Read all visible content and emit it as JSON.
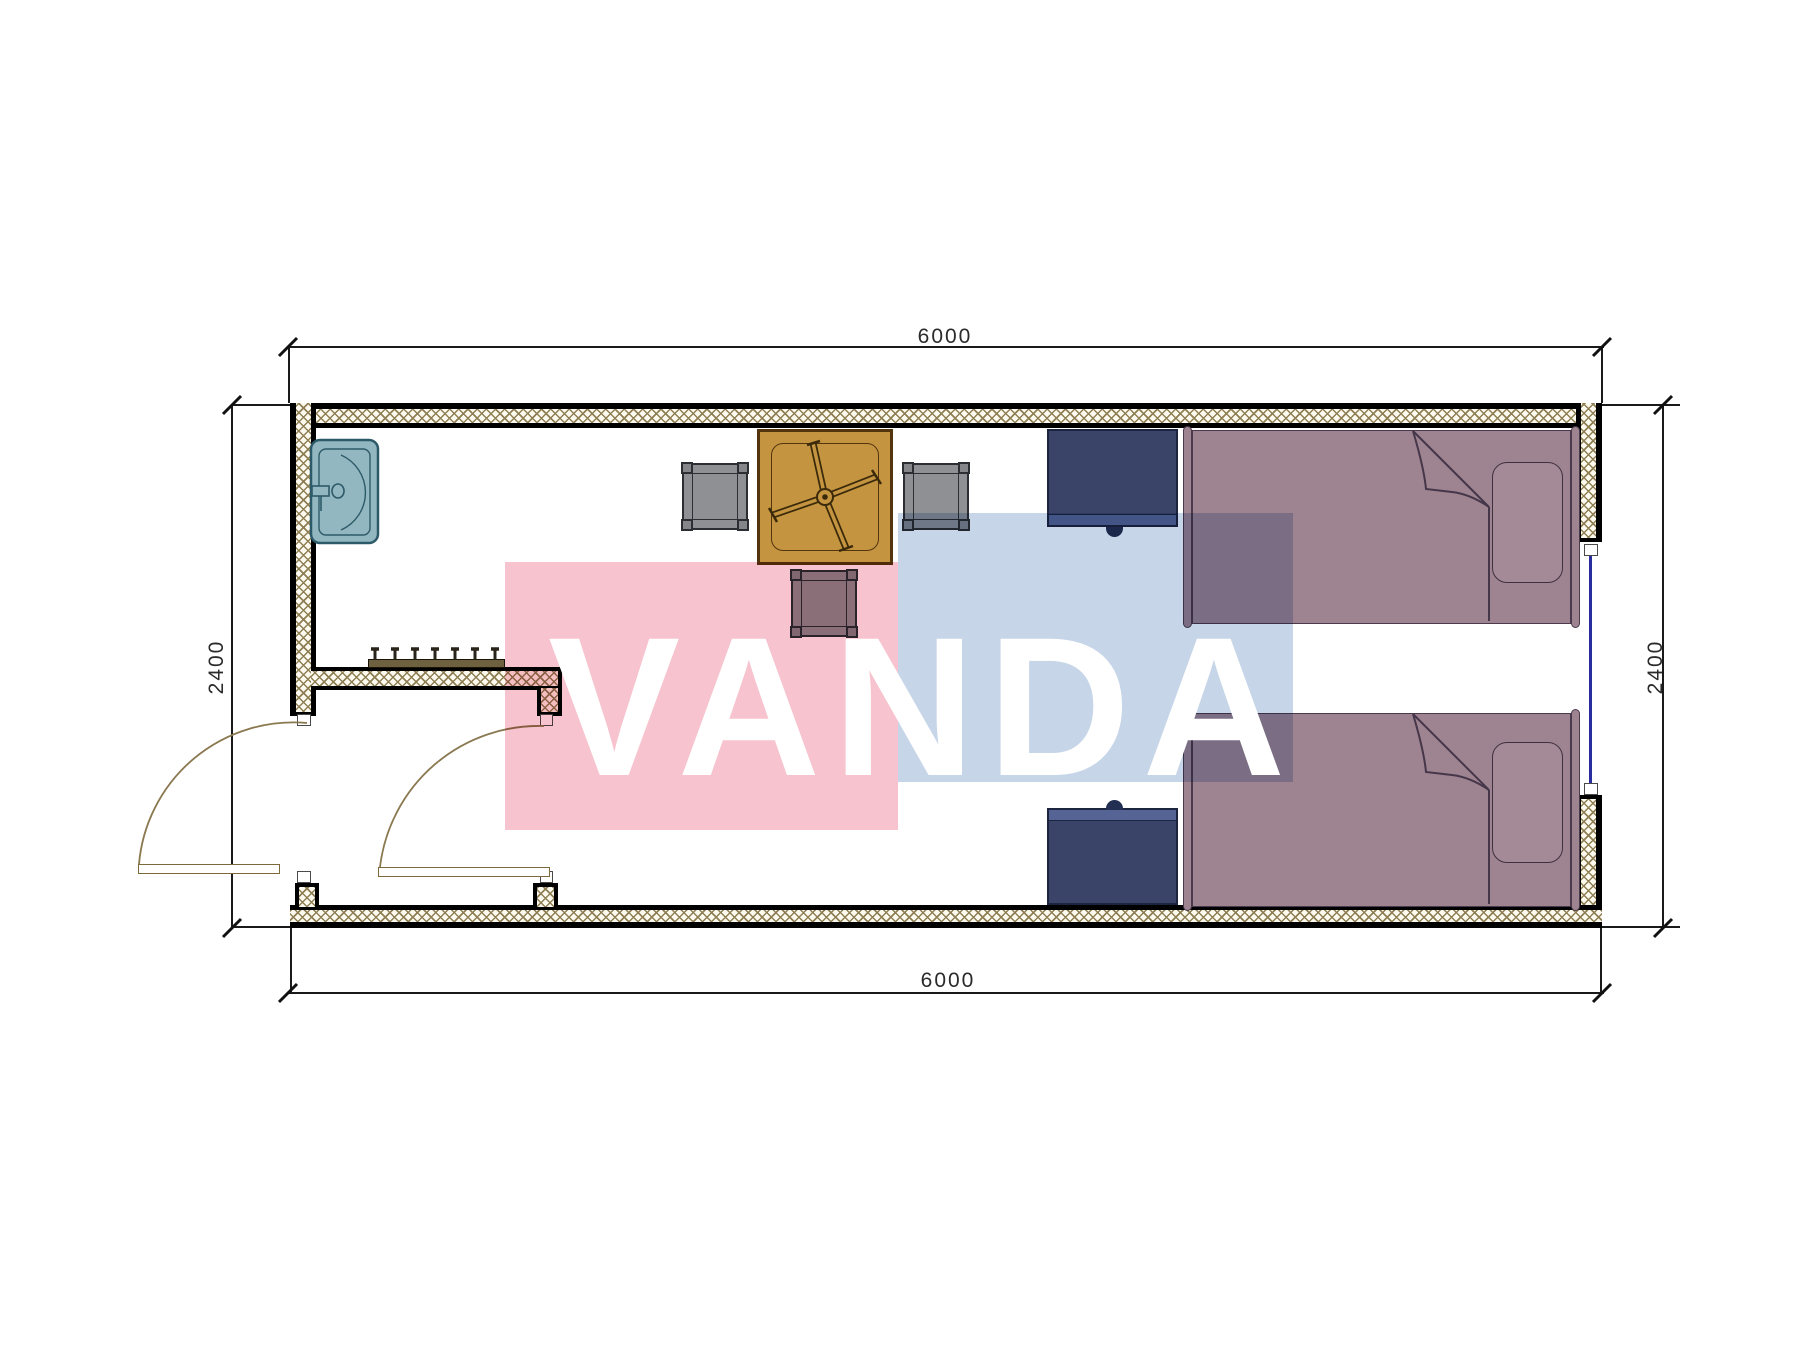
{
  "drawing": {
    "type": "container-house-floor-plan",
    "dimensions": {
      "top": "6000",
      "bottom": "6000",
      "left": "2400",
      "right": "2400"
    },
    "watermark": {
      "text": "VANDA",
      "pink_color": "#f7c3ce",
      "blue_color": "#c7d5e9"
    },
    "rooms": [
      "main-room",
      "entry-vestibule"
    ],
    "furniture": [
      "sink",
      "coat-hook-rack",
      "dining-table",
      "chair-left",
      "chair-right",
      "chair-bottom",
      "nightstand-upper",
      "nightstand-lower",
      "single-bed-upper",
      "single-bed-lower"
    ],
    "openings": [
      "door-left-wall",
      "door-bottom-wall",
      "window-right-wall"
    ],
    "colors": {
      "wall_hatch": "#8f7f54",
      "wall_fill": "#fcf9ee",
      "bed": "#9e8490",
      "nightstand": "#3a4468",
      "table": "#c59440",
      "chair": "#8e9094",
      "sink": "#93b7c0",
      "window_glazing": "#2a2d9e",
      "door_swing": "#8a7850"
    }
  }
}
